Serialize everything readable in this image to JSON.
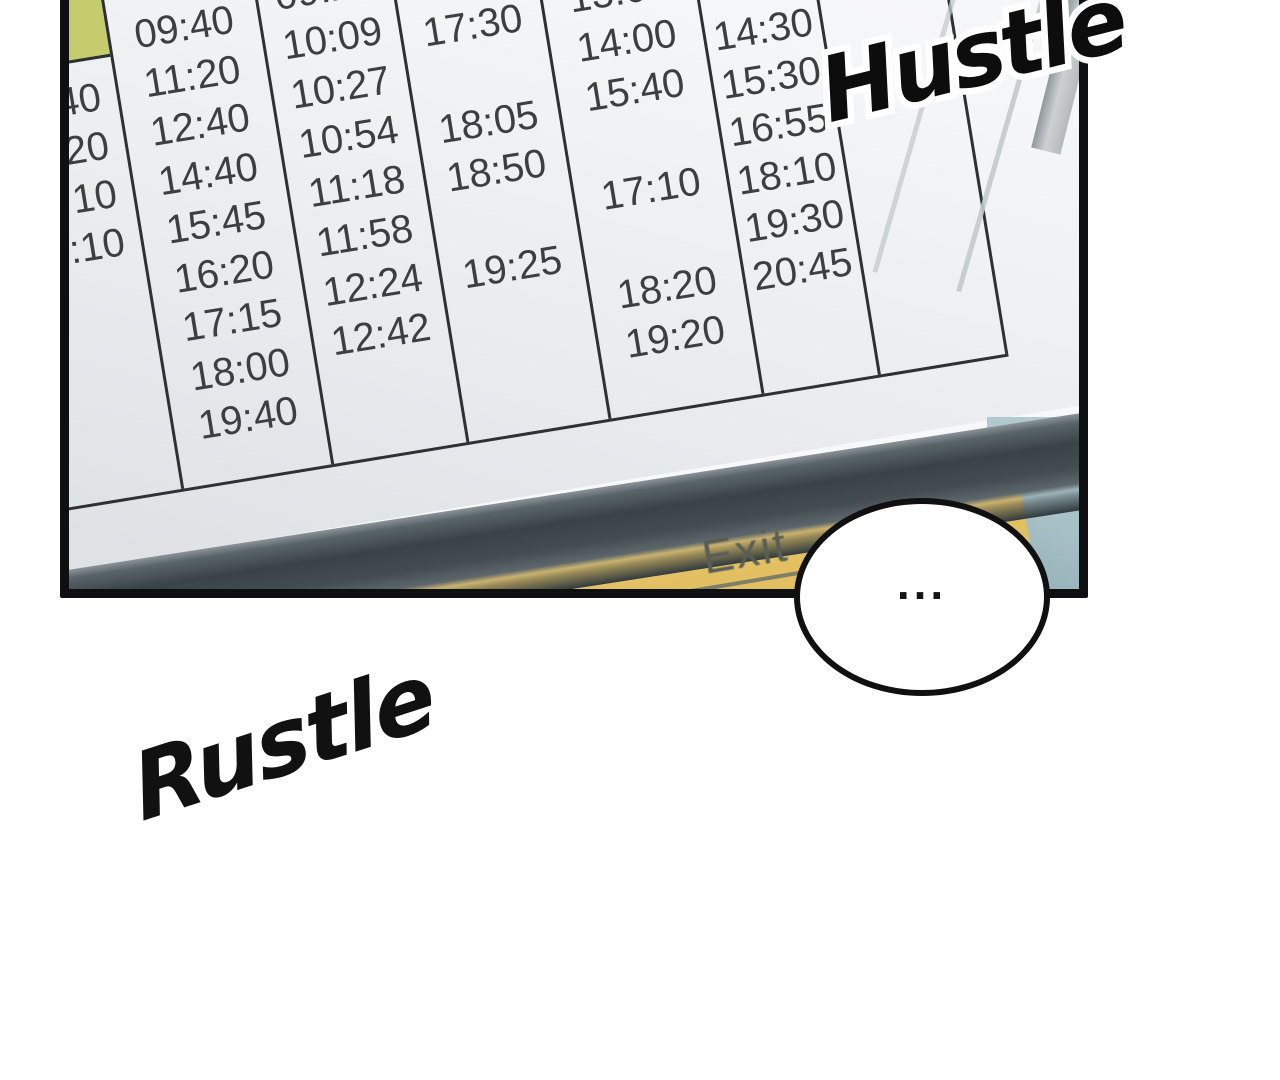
{
  "panel": {
    "border_color": "#0e0f10",
    "board_bg": "#f2f3f5",
    "line_color": "#2d3134",
    "time_color": "#3b3f42",
    "header_cell_color": "#c6cc6d",
    "frame_color": "#3a4347",
    "teal_wall_color": "#a6c0c6",
    "sign_color": "#dfbc5d"
  },
  "timetable": {
    "columns": [
      {
        "id": "col-1",
        "has_header_cell": true,
        "clipped": true,
        "times": [
          {
            "label": "40",
            "row": 0
          },
          {
            "label": "20",
            "row": 1
          },
          {
            "label": "10",
            "row": 2
          },
          {
            "label": ":10",
            "row": 3
          }
        ]
      },
      {
        "id": "col-2",
        "times": [
          {
            "label": "09:40",
            "row": 0
          },
          {
            "label": "11:20",
            "row": 1
          },
          {
            "label": "12:40",
            "row": 2
          },
          {
            "label": "14:40",
            "row": 3
          },
          {
            "label": "15:45",
            "row": 4
          },
          {
            "label": "16:20",
            "row": 5
          },
          {
            "label": "17:15",
            "row": 6
          },
          {
            "label": "18:00",
            "row": 7
          },
          {
            "label": "19:40",
            "row": 8
          }
        ]
      },
      {
        "id": "col-3",
        "times": [
          {
            "label": "09:20",
            "row": 0,
            "clipped_top": true
          },
          {
            "label": "10:09",
            "row": 1
          },
          {
            "label": "10:27",
            "row": 2
          },
          {
            "label": "10:54",
            "row": 3
          },
          {
            "label": "11:18",
            "row": 4
          },
          {
            "label": "11:58",
            "row": 5
          },
          {
            "label": "12:24",
            "row": 6
          },
          {
            "label": "12:42",
            "row": 7
          }
        ]
      },
      {
        "id": "col-4",
        "times": [
          {
            "label": "17:30",
            "row": 0
          },
          {
            "label": "18:05",
            "row": 2
          },
          {
            "label": "18:50",
            "row": 3
          },
          {
            "label": "19:25",
            "row": 5
          }
        ]
      },
      {
        "id": "col-5",
        "times": [
          {
            "label": "13:05",
            "row": 0,
            "clipped_top": true
          },
          {
            "label": "14:00",
            "row": 1
          },
          {
            "label": "15:40",
            "row": 2
          },
          {
            "label": "17:10",
            "row": 4
          },
          {
            "label": "18:20",
            "row": 6
          },
          {
            "label": "19:20",
            "row": 7
          }
        ]
      },
      {
        "id": "col-6",
        "times": [
          {
            "label": "14:30",
            "row": 0
          },
          {
            "label": "15:30",
            "row": 1
          },
          {
            "label": "16:55",
            "row": 2
          },
          {
            "label": "18:10",
            "row": 3
          },
          {
            "label": "19:30",
            "row": 4
          },
          {
            "label": "20:45",
            "row": 5
          }
        ]
      },
      {
        "id": "col-7",
        "times": []
      }
    ]
  },
  "exit_sign": {
    "label": "Exit",
    "text_color": "#585e55"
  },
  "speech_bubble": {
    "text": "..."
  },
  "sfx": {
    "top_right": "Hustle",
    "bottom_left": "Rustle"
  }
}
